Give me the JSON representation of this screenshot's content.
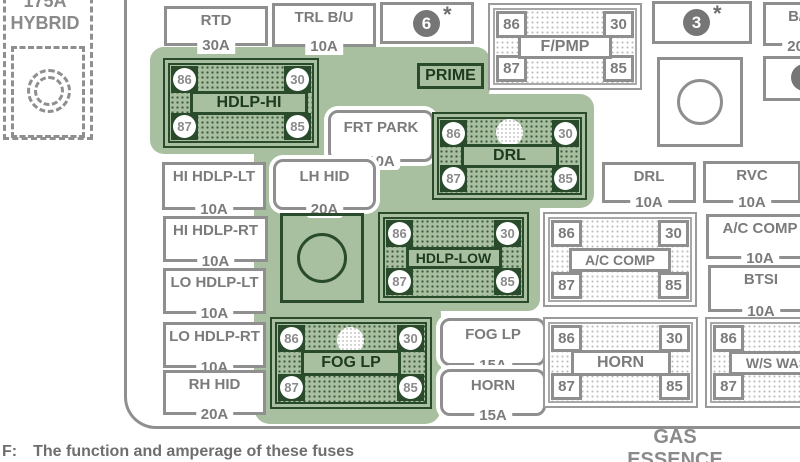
{
  "pin_labels": {
    "tl": "86",
    "tr": "30",
    "bl": "87",
    "br": "85"
  },
  "hybrid": {
    "amp": "175A",
    "name": "HYBRID"
  },
  "fuse_boxes": {
    "rtd": {
      "label": "RTD",
      "amp": "30A"
    },
    "trl_bu": {
      "label": "TRL B/U",
      "amp": "10A"
    },
    "frt_park": {
      "label": "FRT PARK",
      "amp": "10A"
    },
    "lh_hid": {
      "label": "LH HID",
      "amp": "20A"
    },
    "hi_hdlp_lt": {
      "label": "HI HDLP-LT",
      "amp": "10A"
    },
    "hi_hdlp_rt": {
      "label": "HI HDLP-RT",
      "amp": "10A"
    },
    "lo_hdlp_lt": {
      "label": "LO HDLP-LT",
      "amp": "10A"
    },
    "lo_hdlp_rt": {
      "label": "LO HDLP-RT",
      "amp": "10A"
    },
    "rh_hid": {
      "label": "RH HID",
      "amp": "20A"
    },
    "fog_lp": {
      "label": "FOG LP",
      "amp": "15A"
    },
    "horn": {
      "label": "HORN",
      "amp": "15A"
    },
    "drl": {
      "label": "DRL",
      "amp": "10A"
    },
    "rvc": {
      "label": "RVC",
      "amp": "10A"
    },
    "ac_comp": {
      "label": "A/C COMP",
      "amp": "10A"
    },
    "btsi": {
      "label": "BTSI",
      "amp": "10A"
    },
    "bu_partial": {
      "label": "B/U",
      "amp": "20A"
    },
    "prime": {
      "label": "PRIME"
    }
  },
  "relays": {
    "hdlp_hi": {
      "name": "HDLP-HI"
    },
    "drl": {
      "name": "DRL"
    },
    "hdlp_low": {
      "name": "HDLP-LOW"
    },
    "fog_lp": {
      "name": "FOG LP"
    },
    "f_pmp": {
      "name": "F/PMP"
    },
    "ac_comp": {
      "name": "A/C COMP"
    },
    "horn": {
      "name": "HORN"
    },
    "ws_wash": {
      "name": "W/S WASH"
    }
  },
  "badges": {
    "six": "6",
    "three": "3",
    "star": "*"
  },
  "bottom_label": {
    "line1": "GAS",
    "line2": "ESSENCE"
  },
  "footnote": {
    "prefix": "F:",
    "text": "The function and amperage of these fuses"
  },
  "colors": {
    "sage": "#a8bfa0",
    "dark_green": "#2a4a2c",
    "outline_gray": "#8f8f8f",
    "text_gray": "#7b7b7b"
  }
}
